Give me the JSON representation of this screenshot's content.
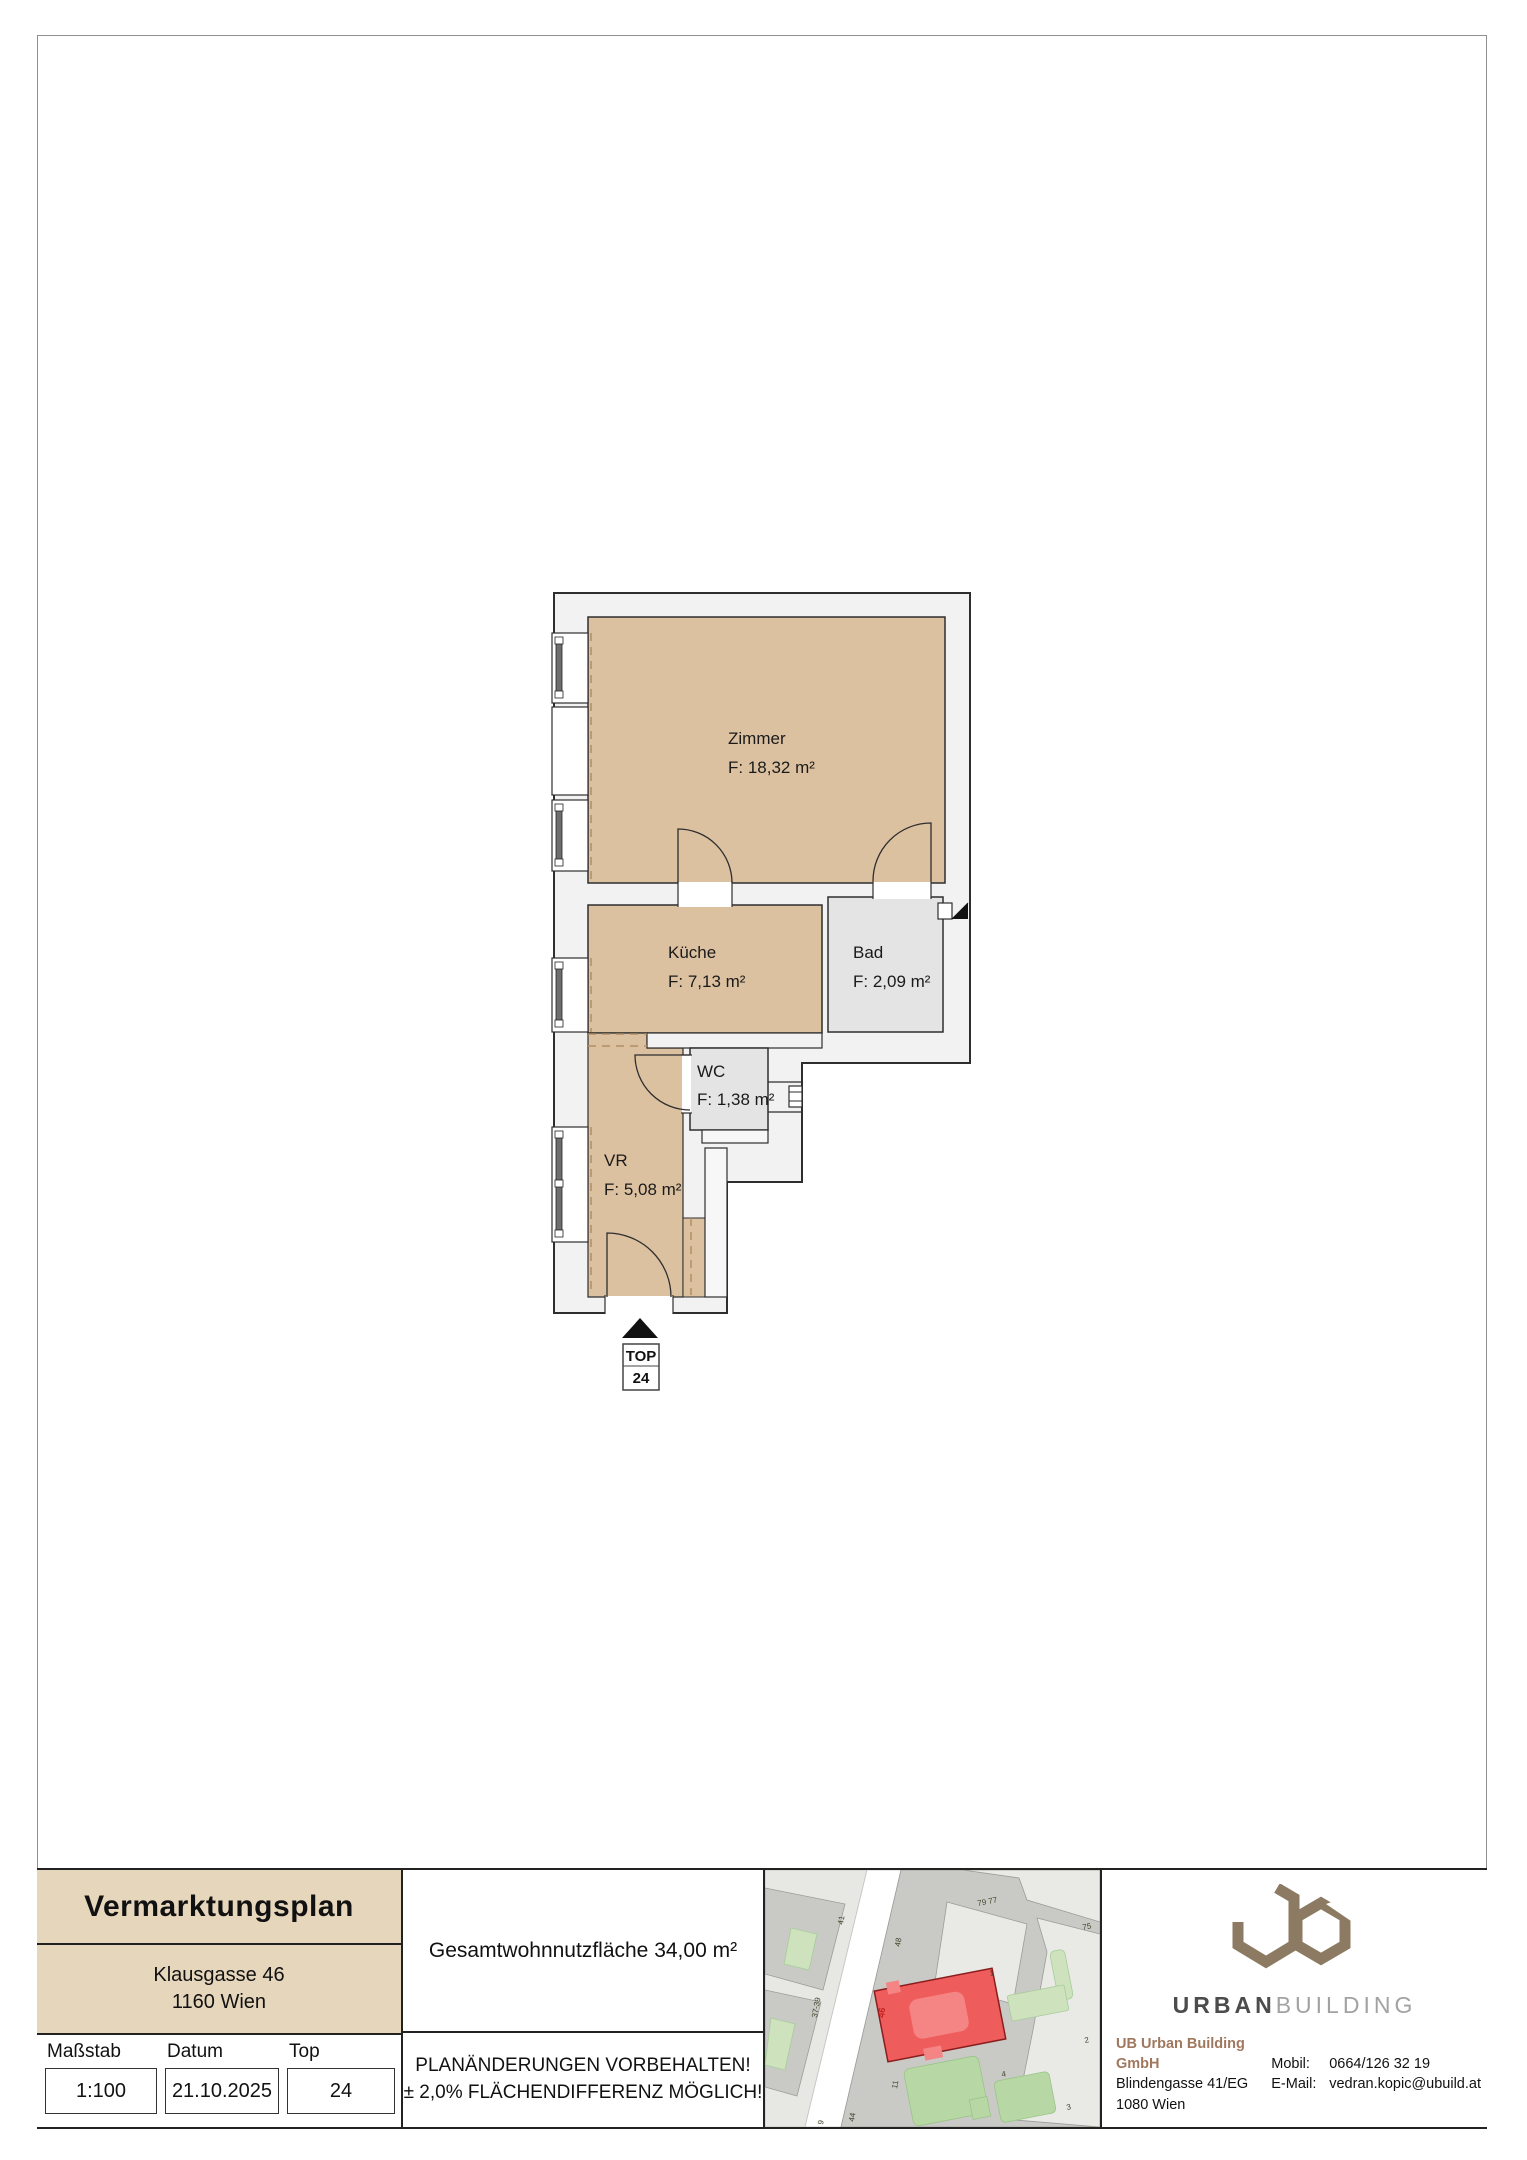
{
  "plan": {
    "rooms": [
      {
        "key": "zimmer",
        "name": "Zimmer",
        "area": "F: 18,32 m²"
      },
      {
        "key": "kueche",
        "name": "Küche",
        "area": "F: 7,13 m²"
      },
      {
        "key": "bad",
        "name": "Bad",
        "area": "F: 2,09 m²"
      },
      {
        "key": "wc",
        "name": "WC",
        "area": "F: 1,38 m²"
      },
      {
        "key": "vr",
        "name": "VR",
        "area": "F: 5,08 m²"
      }
    ],
    "top_marker": {
      "line1": "TOP",
      "line2": "24"
    }
  },
  "title_block": {
    "title": "Vermarktungsplan",
    "address_line1": "Klausgasse 46",
    "address_line2": "1160 Wien",
    "fields": [
      {
        "label": "Maßstab",
        "value": "1:100"
      },
      {
        "label": "Datum",
        "value": "21.10.2025"
      },
      {
        "label": "Top",
        "value": "24"
      }
    ],
    "total_area": "Gesamtwohnnutzfläche  34,00 m²",
    "disclaimer1": "PLANÄNDERUNGEN VORBEHALTEN!",
    "disclaimer2": "± 2,0% FLÄCHENDIFFERENZ MÖGLICH!"
  },
  "site_map": {
    "highlight": "46",
    "labels": [
      "79 77",
      "75",
      "41",
      "48",
      "37-39",
      "1",
      "2",
      "4",
      "11",
      "44",
      "3",
      "9"
    ]
  },
  "brand": {
    "wordmark_primary": "URBAN",
    "wordmark_secondary": "BUILDING",
    "company": "UB Urban Building GmbH",
    "address1": "Blindengasse 41/EG",
    "address2": "1080 Wien",
    "mobile_label": "Mobil:",
    "mobile": "0664/126 32 19",
    "email_label": "E-Mail:",
    "email": "vedran.kopic@ubuild.at"
  },
  "colors": {
    "room_tan": "#dcc1a1",
    "room_gray": "#e4e4e4",
    "wall_fill": "#f2f2f2",
    "beige": "#e6d6bc",
    "brand_taupe": "#8c7b62",
    "map_red": "#ef5c5c"
  }
}
